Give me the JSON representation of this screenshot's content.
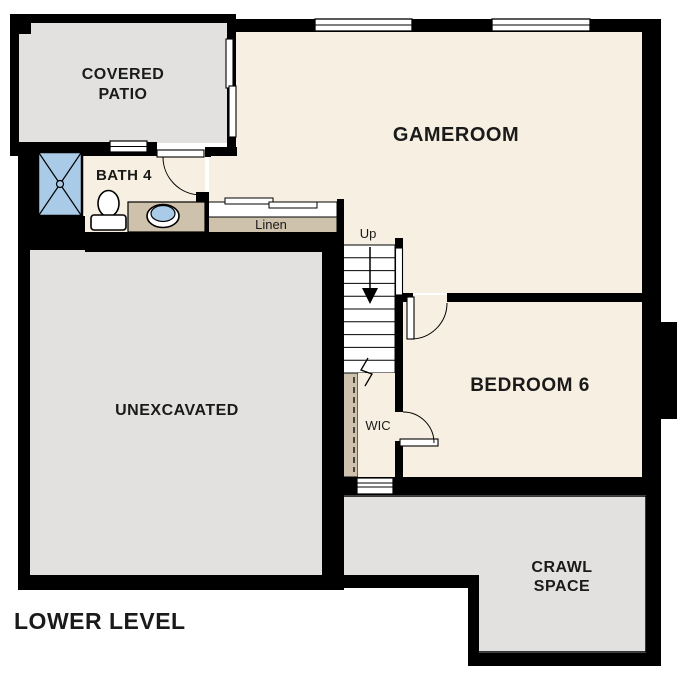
{
  "plan": {
    "title": "LOWER LEVEL",
    "level": "Lower Level Floor Plan"
  },
  "colors": {
    "wall": "#000000",
    "floor": "#F7EFE2",
    "concrete": "#E2E1E0",
    "cabinet": "#CEC2AC",
    "fixture_blue": "#A9CBE8",
    "white": "#FFFFFF",
    "text": "#1A1A1A"
  },
  "rooms": {
    "covered_patio": {
      "label_line1": "COVERED",
      "label_line2": "PATIO"
    },
    "gameroom": {
      "label": "GAMEROOM"
    },
    "bath4": {
      "label": "BATH 4"
    },
    "linen": {
      "label": "Linen"
    },
    "unexcavated": {
      "label": "UNEXCAVATED"
    },
    "bedroom6": {
      "label": "BEDROOM 6"
    },
    "wic": {
      "label": "WIC"
    },
    "crawl_space": {
      "label_line1": "CRAWL",
      "label_line2": "SPACE"
    }
  },
  "stairs": {
    "direction_label": "Up"
  }
}
